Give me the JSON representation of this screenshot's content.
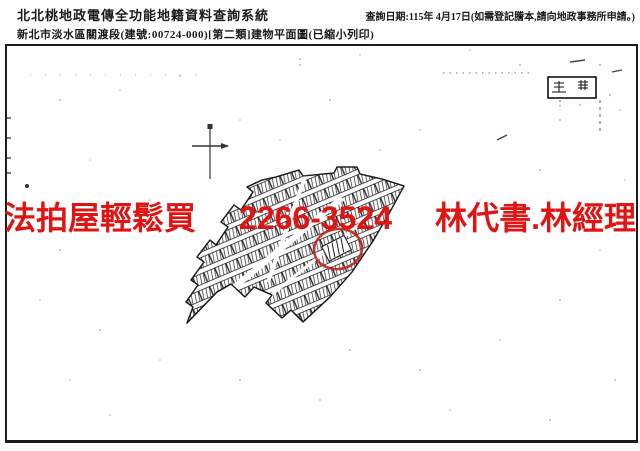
{
  "header": {
    "system_title": "北北桃地政電傳全功能地籍資料查詢系統",
    "subtitle": "新北市淡水區關渡段(建號:00724-000)[第二類]建物平面圖(已縮小列印)",
    "query_date": "查詢日期:115年 4月17日(如需登記謄本,請向地政事務所申請。)"
  },
  "watermark": {
    "left": "法拍屋輕鬆買",
    "phone": "2266-3524",
    "right": "林代書.林經理",
    "color": "#e11414"
  },
  "map": {
    "kind": "building-floor-plan-scan",
    "ink_color": "#1c1c1c",
    "highlight_circle_color": "#c4231b"
  }
}
